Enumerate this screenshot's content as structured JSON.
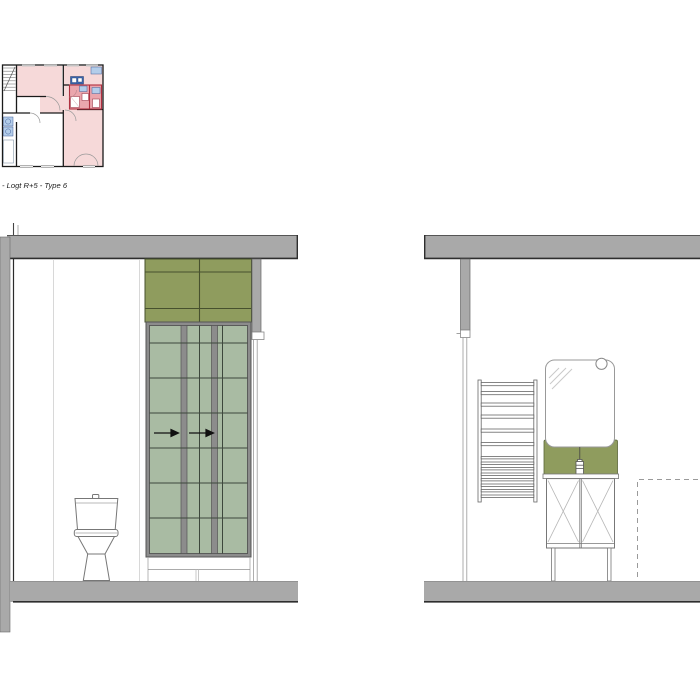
{
  "plan": {
    "caption": "- Logt R+5 - Type 6"
  },
  "drawing_elements": {
    "left_elevation": [
      "ceiling-slab",
      "side-wall",
      "upper-cabinet-panel",
      "glazed-sliding-partition",
      "sliding-direction-arrows",
      "toilet",
      "wall-post",
      "floor-slab"
    ],
    "right_elevation": [
      "ceiling-slab",
      "wall-post",
      "towel-radiator",
      "mirror",
      "mirror-light",
      "washbasin-splashback",
      "faucet",
      "vanity-cabinet",
      "cabinet-legs",
      "reservation-dashed-outline",
      "floor-slab"
    ]
  },
  "colors": {
    "slab_gray": "#a9a9a9",
    "slab_edge": "#2e2e2e",
    "olive_panel": "#8f9c5e",
    "olive_line": "#47512e",
    "glass_green": "#a9bba3",
    "glass_line": "#3d473c",
    "frame_gray": "#8c8c8c",
    "fixture_line": "#777777",
    "faint_line": "#cfcfcf",
    "dash_line": "#9a9a9a",
    "plan_pink": "#f6d9d9",
    "plan_red": "#eaa6ad",
    "plan_red_line": "#b03040",
    "plan_blue": "#b3cdea",
    "plan_blue_dark": "#3c69b5",
    "plan_wall": "#1a1a1a"
  }
}
